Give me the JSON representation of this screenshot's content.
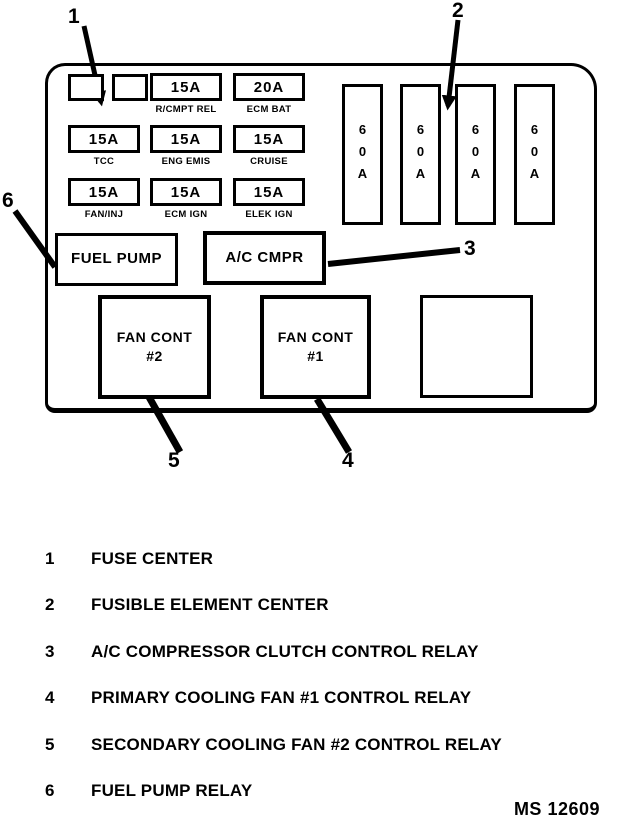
{
  "diagram_title": "fuse and relay center diagram",
  "fusebox": {
    "empty_fuse_slots": 2,
    "empty_relay_slots": 1,
    "fuses": [
      {
        "amp": "15A",
        "label": "R/CMPT REL"
      },
      {
        "amp": "20A",
        "label": "ECM BAT"
      },
      {
        "amp": "15A",
        "label": "TCC"
      },
      {
        "amp": "15A",
        "label": "ENG EMIS"
      },
      {
        "amp": "15A",
        "label": "CRUISE"
      },
      {
        "amp": "15A",
        "label": "FAN/INJ"
      },
      {
        "amp": "15A",
        "label": "ECM IGN"
      },
      {
        "amp": "15A",
        "label": "ELEK IGN"
      }
    ],
    "fusible_elements": [
      {
        "amp": "60A"
      },
      {
        "amp": "60A"
      },
      {
        "amp": "60A"
      },
      {
        "amp": "60A"
      }
    ],
    "relays": {
      "fuel_pump": "FUEL PUMP",
      "ac_cmpr": "A/C CMPR",
      "fan2_line1": "FAN CONT",
      "fan2_line2": "#2",
      "fan1_line1": "FAN CONT",
      "fan1_line2": "#1"
    }
  },
  "callouts": {
    "c1": "1",
    "c2": "2",
    "c3": "3",
    "c4": "4",
    "c5": "5",
    "c6": "6"
  },
  "legend": [
    {
      "num": "1",
      "text": "FUSE CENTER"
    },
    {
      "num": "2",
      "text": "FUSIBLE ELEMENT CENTER"
    },
    {
      "num": "3",
      "text": "A/C COMPRESSOR CLUTCH CONTROL RELAY"
    },
    {
      "num": "4",
      "text": "PRIMARY COOLING FAN #1 CONTROL RELAY"
    },
    {
      "num": "5",
      "text": "SECONDARY COOLING FAN #2 CONTROL RELAY"
    },
    {
      "num": "6",
      "text": "FUEL PUMP RELAY"
    }
  ],
  "footer": {
    "code": "MS 12609"
  },
  "colors": {
    "ink": "#000000",
    "paper": "#ffffff"
  }
}
